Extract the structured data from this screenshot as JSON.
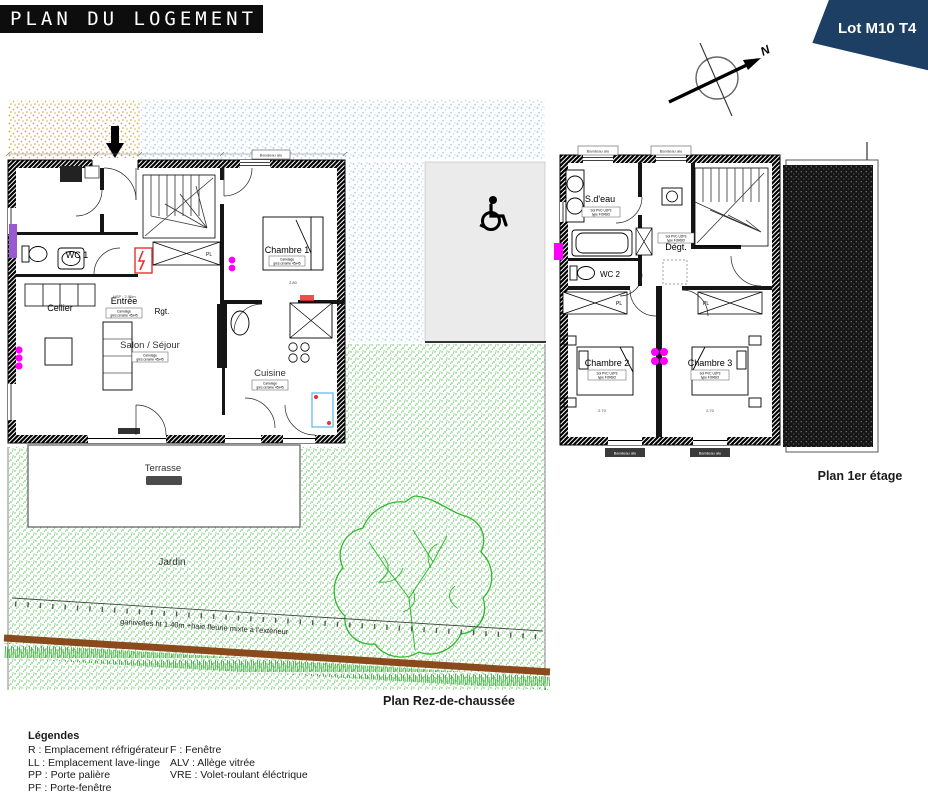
{
  "header": {
    "title": "PLAN DU LOGEMENT",
    "lot": "Lot M10 T4"
  },
  "compass": {
    "north": "N"
  },
  "ground_floor": {
    "caption": "Plan Rez-de-chaussée",
    "rooms": {
      "cellier": "Cellier",
      "entree": "Entrée",
      "rgt": "Rgt.",
      "wc1": "WC 1",
      "chambre1": "Chambre 1",
      "salon": "Salon / Séjour",
      "cuisine": "Cuisine",
      "pl": "PL",
      "terrasse": "Terrasse",
      "jardin": "Jardin"
    },
    "notes": {
      "fence": "ganivelles ht 1.40m +haie fleurie mixte à l'extérieur",
      "floor_line1": "Carrelage",
      "floor_line2": "grès cérame 45x45",
      "hsp": "HSP : 2.50m",
      "dim_chambre1": "2.80"
    }
  },
  "first_floor": {
    "caption": "Plan 1er étage",
    "rooms": {
      "sdeau": "S.d'eau",
      "degt": "Dégt.",
      "wc2": "WC 2",
      "chambre2": "Chambre 2",
      "chambre3": "Chambre 3",
      "pl": "PL"
    },
    "notes": {
      "band": "Bandeau alu",
      "floor_line1": "Sol PVC U2P3",
      "floor_line2": "type FORBO",
      "dim": "2.70"
    }
  },
  "legend": {
    "title": "Légendes",
    "col1": [
      "R : Emplacement réfrigérateur",
      "LL : Emplacement lave-linge",
      "PP : Porte palière",
      "PF : Porte-fenêtre"
    ],
    "col2": [
      "F : Fenêtre",
      "ALV : Allège vitrée",
      "VRE : Volet-roulant éléctrique"
    ]
  },
  "colors": {
    "banner_navy": "#1c3f63",
    "title_black": "#0d0d0d",
    "magenta": "#ff00ff",
    "garden_green": "#4fc24f",
    "hedge_brown": "#8a4a1c",
    "sand": "#d9a43b",
    "path_blue": "#9ec4ea",
    "alert_red": "#e63030",
    "window_blue": "#59b7e8"
  }
}
